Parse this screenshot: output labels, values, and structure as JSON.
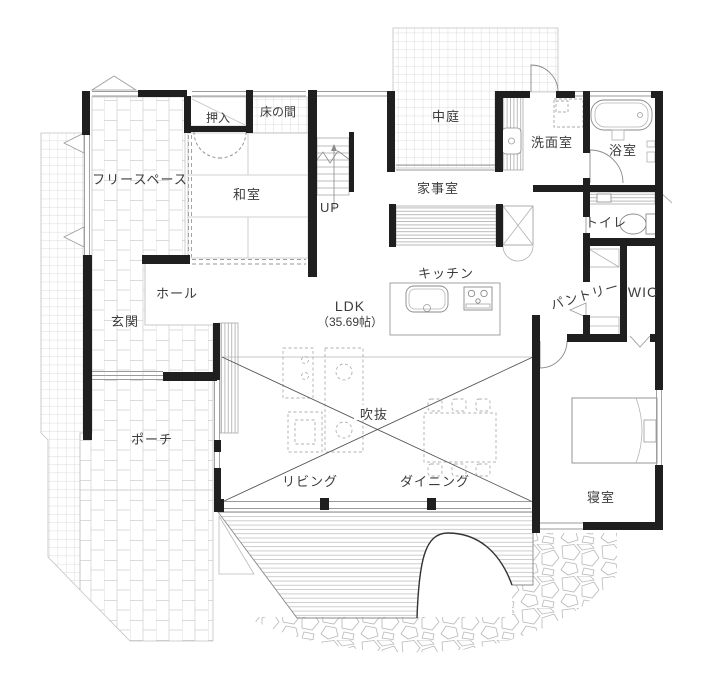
{
  "plan": {
    "type": "floor-plan",
    "floor_area_note": "LDK total 35.69 tatami mats"
  },
  "colors": {
    "wall": "#1f1f1f",
    "thin_line": "#b5b5b5",
    "medium_line": "#8a8a8a",
    "text": "#3c3c3c",
    "background": "#ffffff"
  },
  "rooms": {
    "free_space": {
      "label": "フリースペース"
    },
    "oshiire": {
      "label": "押入"
    },
    "tokonoma": {
      "label": "床の間"
    },
    "washitsu": {
      "label": "和室"
    },
    "stairs": {
      "label": "UP"
    },
    "nakaniwa": {
      "label": "中庭"
    },
    "senmen": {
      "label": "洗面室"
    },
    "bath": {
      "label": "浴室"
    },
    "kaji": {
      "label": "家事室"
    },
    "toilet": {
      "label": "トイレ"
    },
    "kitchen": {
      "label": "キッチン"
    },
    "hall": {
      "label": "ホール"
    },
    "ldk": {
      "label": "LDK",
      "area_label": "（35.69帖）"
    },
    "genkan": {
      "label": "玄関"
    },
    "pantry": {
      "label": "パントリー"
    },
    "wic": {
      "label": "WIC"
    },
    "fukinuke": {
      "label": "吹抜"
    },
    "porch": {
      "label": "ポーチ"
    },
    "living": {
      "label": "リビング"
    },
    "dining": {
      "label": "ダイニング"
    },
    "bedroom": {
      "label": "寝室"
    }
  }
}
